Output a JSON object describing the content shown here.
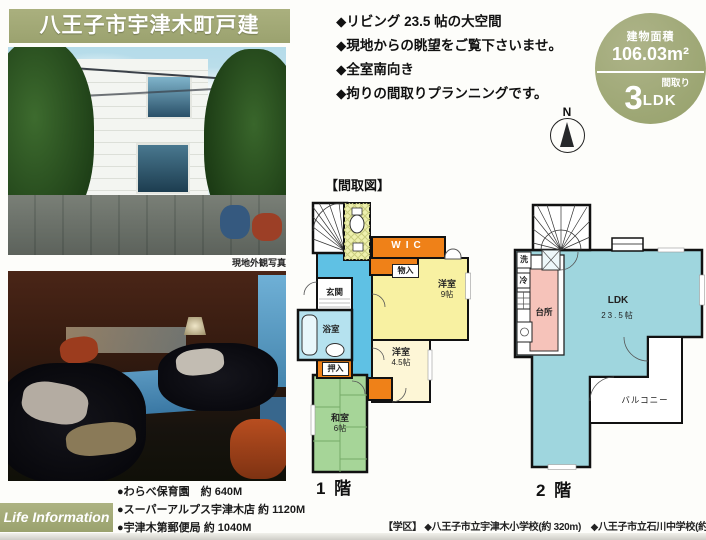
{
  "title": "八王子市宇津木町戸建",
  "features": [
    "◆リビング 23.5 帖の大空間",
    "◆現地からの眺望をご覧下さいませ。",
    "◆全室南向き",
    "◆拘りの間取りプランニングです。"
  ],
  "badge": {
    "area_label": "建物面積",
    "area_value": "106.03m²",
    "plan_label": "間取り",
    "plan_number": "3",
    "plan_unit": "LDK"
  },
  "compass": {
    "north": "N"
  },
  "floorplan": {
    "section_title": "【間取図】",
    "floor1": {
      "label": "1 階",
      "wic": "WIC",
      "storage": "物入",
      "entrance": "玄関",
      "bathroom": "浴室",
      "closet": "押入",
      "western9_name": "洋室",
      "western9_size": "9帖",
      "western45_name": "洋室",
      "western45_size": "4.5帖",
      "japanese_name": "和室",
      "japanese_size": "6帖"
    },
    "floor2": {
      "label": "2 階",
      "kitchen": "台所",
      "ldk_name": "LDK",
      "ldk_size": "23.5帖",
      "balcony": "バルコニー",
      "washer": "洗",
      "fridge": "冷"
    }
  },
  "photos": {
    "exterior_caption": "現地外観写真"
  },
  "life_information": {
    "label": "Life Information",
    "items": [
      "●わらべ保育園　約 640M",
      "●スーパーアルプス宇津木店 約 1120M",
      "●宇津木第郵便局 約 1040M"
    ]
  },
  "school_district": "【学区】 ◆八王子市立宇津木小学校(約 320m)　◆八王子市立石川中学校(約 560m)",
  "colors": {
    "accent_olive": "#a2a878",
    "plan_orange": "#ef8118",
    "plan_yellow": "#f8f1a2",
    "plan_cream": "#fdf6d6",
    "plan_green": "#a6d598",
    "plan_hall_blue": "#5fc1e4",
    "plan_bath_cyan": "#b5e2ef",
    "plan_ldk_cyan": "#9fd6de",
    "plan_kitchen_pink": "#f6c3ba"
  }
}
